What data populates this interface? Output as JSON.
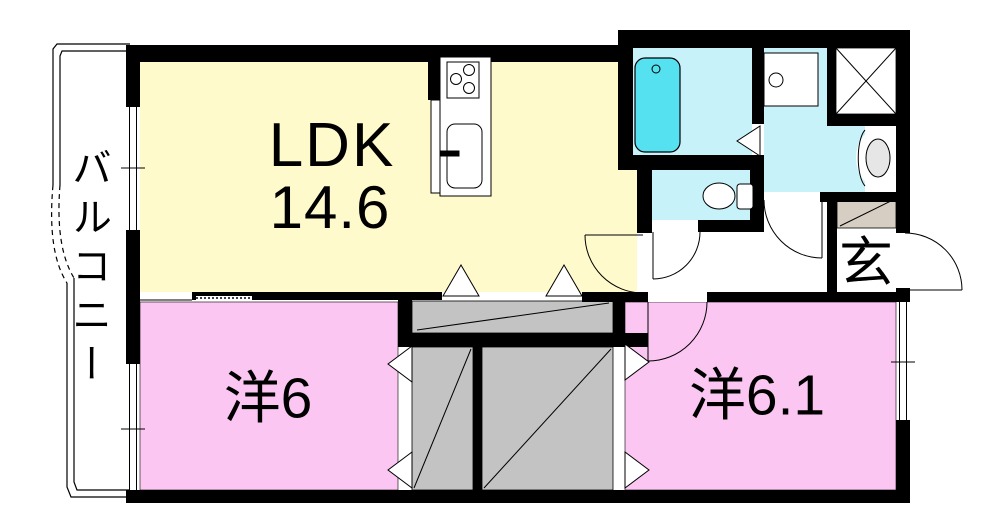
{
  "floorplan": {
    "rooms": {
      "ldk": {
        "label": "LDK",
        "size": "14.6"
      },
      "west_room_1": {
        "label": "洋6"
      },
      "west_room_2": {
        "label": "洋6.1"
      },
      "entrance": {
        "label": "玄"
      },
      "balcony": {
        "label": "バルコニー"
      }
    },
    "colors": {
      "ldk_floor": "#FFFACC",
      "west_room_floor": "#FBC7F2",
      "wet_area_floor": "#C8F2FA",
      "bathtub": "#55E1F0",
      "closet_fill": "#C3C3C3",
      "shoe_cabinet_fill": "#D6CEC2",
      "wall": "#000000",
      "basin_fill": "#E6E6E6"
    },
    "fixtures": [
      "bathtub",
      "washbasin",
      "vanity-basin",
      "toilet",
      "stove",
      "kitchen-sink",
      "washing-machine-space",
      "shoe-cabinet",
      "closet",
      "folding-door",
      "swing-door",
      "window",
      "balcony-divider"
    ]
  }
}
